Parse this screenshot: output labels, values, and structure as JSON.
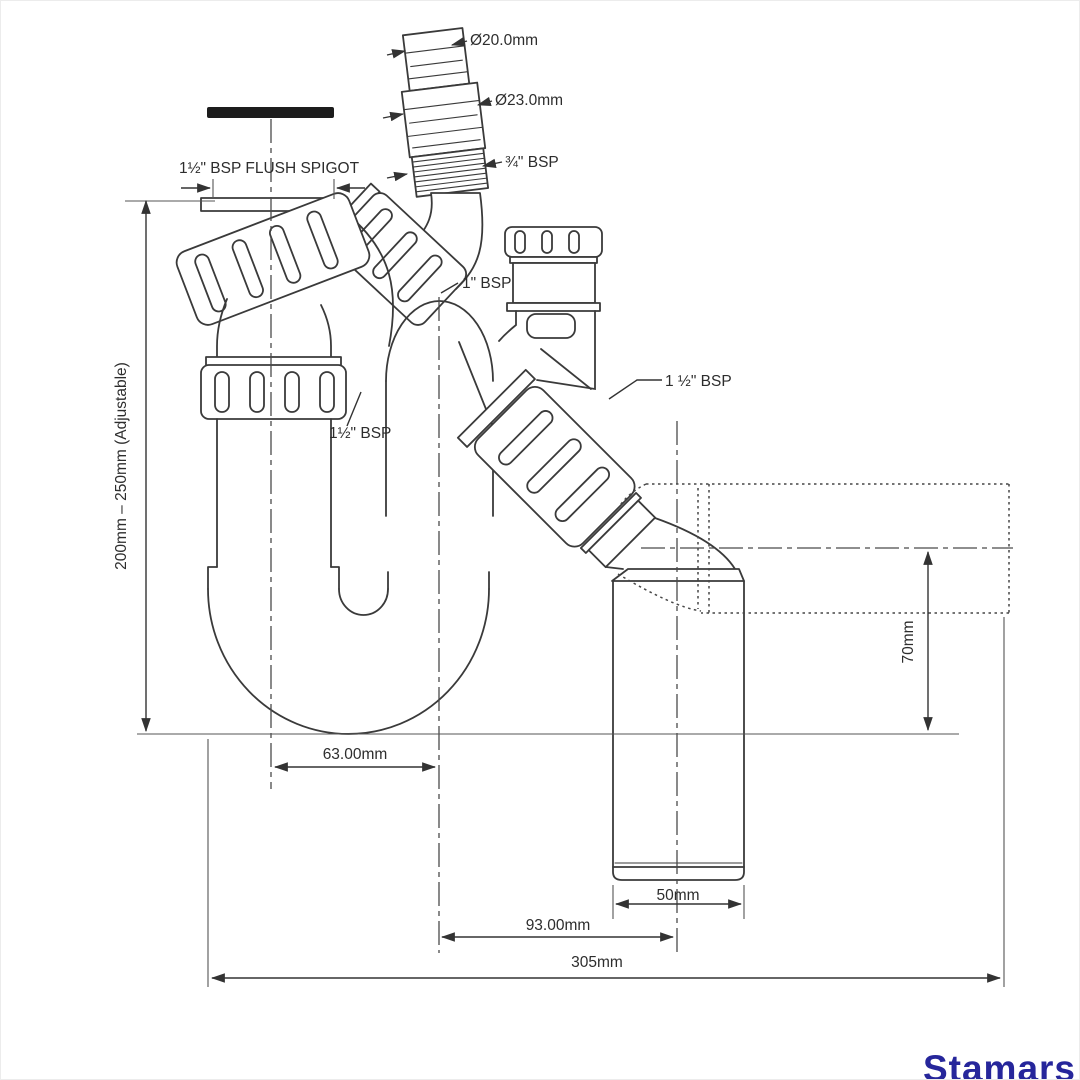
{
  "watermark": {
    "text": "Stamars",
    "color": "#26269b"
  },
  "drawing": {
    "line_color": "#3a3a3a",
    "labels": {
      "hose_od_top": "Ø20.0mm",
      "hose_od_mid": "Ø23.0mm",
      "hose_thread": "¾\" BSP",
      "flush_spigot": "1½\" BSP FLUSH SPIGOT",
      "inlet_thread": "1\" BSP",
      "outlet_thread": "1 ½\" BSP",
      "union_thread": "1½\" BSP"
    },
    "dimensions": {
      "height_adjustable": "200mm – 250mm (Adjustable)",
      "bend_centres": "63.00mm",
      "outlet_drop": "70mm",
      "outlet_pipe": "50mm",
      "outlet_centre_offset": "93.00mm",
      "overall_length": "305mm"
    }
  }
}
